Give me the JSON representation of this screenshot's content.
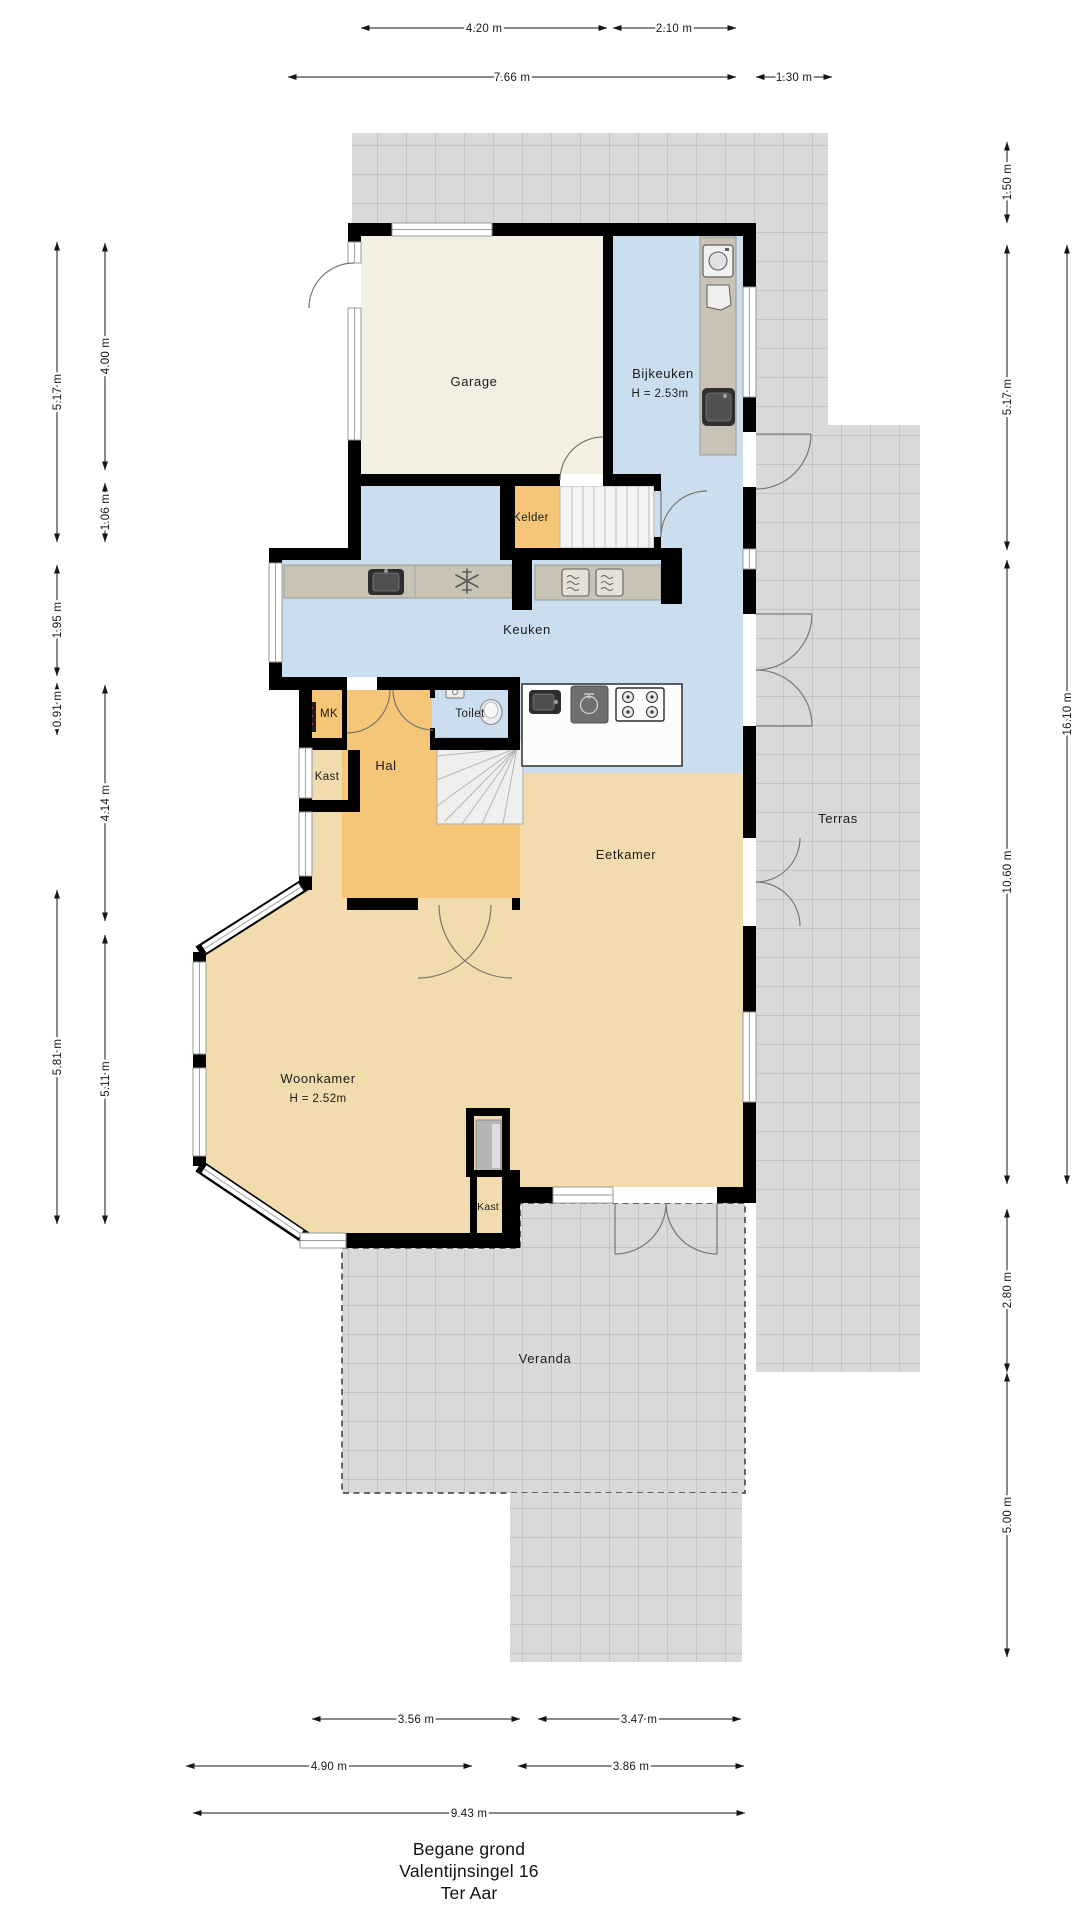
{
  "title": {
    "line1": "Begane grond",
    "line2": "Valentijnsingel 16",
    "line3": "Ter Aar"
  },
  "rooms": {
    "garage": {
      "label": "Garage"
    },
    "bijkeuken": {
      "label": "Bijkeuken",
      "height": "H = 2.53m"
    },
    "kelder": {
      "label": "Kelder"
    },
    "keuken": {
      "label": "Keuken"
    },
    "mk": {
      "label": "MK"
    },
    "toilet": {
      "label": "Toilet"
    },
    "hal": {
      "label": "Hal"
    },
    "eetkamer": {
      "label": "Eetkamer"
    },
    "terras": {
      "label": "Terras"
    },
    "kast_hal": {
      "label": "Kast"
    },
    "woonkamer": {
      "label": "Woonkamer",
      "height": "H = 2.52m"
    },
    "kast_woonkamer": {
      "label": "Kast"
    },
    "veranda": {
      "label": "Veranda"
    }
  },
  "dims": {
    "top": [
      "4.20 m",
      "2.10 m",
      "7.66 m",
      "1.30 m"
    ],
    "left": [
      "5.17 m",
      "4.00 m",
      "1.06 m",
      "1.95 m",
      "0.91 m",
      "4.14 m",
      "5.81 m",
      "5.11 m"
    ],
    "right": [
      "1.50 m",
      "5.17 m",
      "16.10 m",
      "10.60 m",
      "2.80 m",
      "5.00 m"
    ],
    "bottom": [
      "3.56 m",
      "3.47 m",
      "4.90 m",
      "3.86 m",
      "9.43 m"
    ]
  },
  "colors": {
    "wall": "#000000",
    "kitchen_floor": "#cbdeef",
    "hall_floor": "#f5c578",
    "living_floor": "#f2dcae",
    "garage_floor": "#f3f0e3",
    "tile": "#d9d9d9",
    "tile_line": "#aeaeae",
    "counter": "#c8c3b4"
  },
  "icons": {
    "washing_machine": "washing-machine-icon",
    "laundry_basket": "laundry-basket-icon",
    "utility_sink": "utility-sink-icon",
    "kitchen_sink": "kitchen-sink-icon",
    "freezer_snowflake": "snowflake-icon",
    "oven_left": "oven-icon",
    "oven_right": "oven-icon",
    "island_sink": "island-sink-icon",
    "dishwasher": "dishwasher-icon",
    "gas_hob": "gas-hob-icon",
    "hand_basin": "hand-basin-icon",
    "wc": "toilet-bowl-icon",
    "fuse_box": "fuse-box-icon",
    "stove": "wood-stove-icon"
  }
}
